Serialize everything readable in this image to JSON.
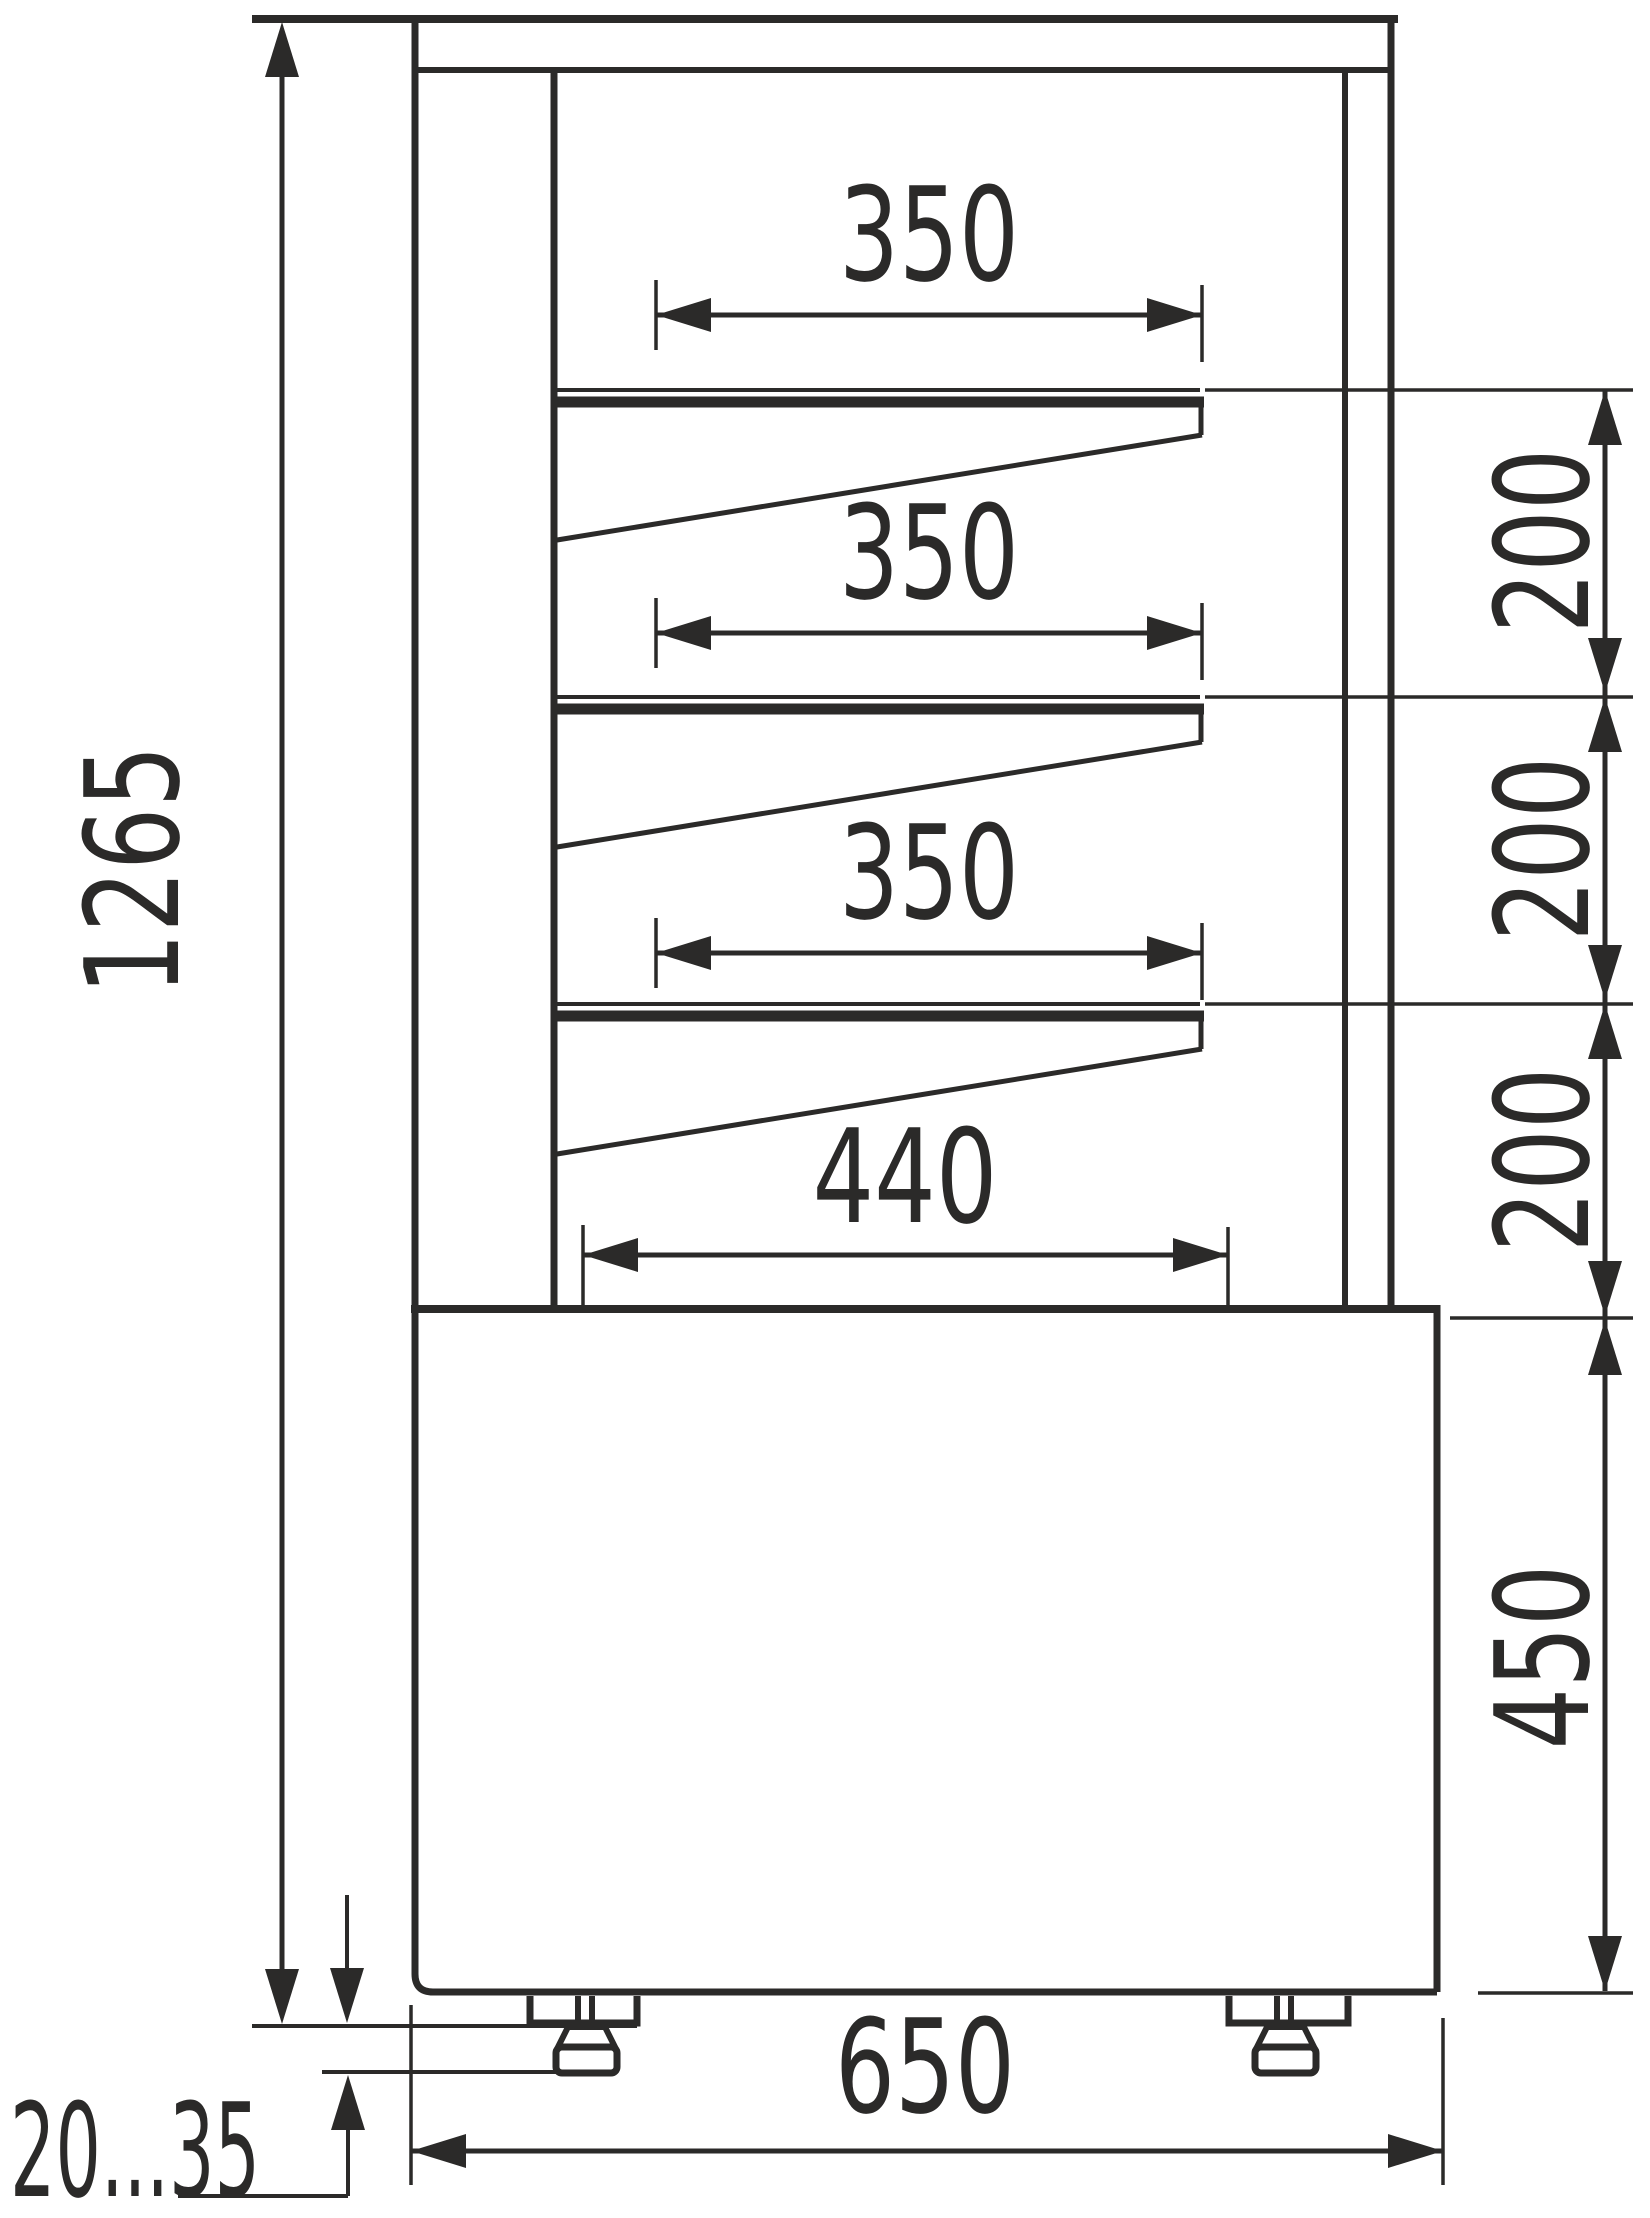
{
  "meta": {
    "drawing_type": "technical dimension drawing",
    "subject": "refrigerated confectionery display case - side section with shelves and adjustable feet",
    "line_color": "#2b2a29",
    "background_color": "#ffffff"
  },
  "dims": {
    "shelf_depth_1": "350",
    "shelf_depth_2": "350",
    "shelf_depth_3": "350",
    "bottom_depth": "440",
    "shelf_pitch_1": "200",
    "shelf_pitch_2": "200",
    "shelf_pitch_3": "200",
    "base_height": "450",
    "overall_height": "1265",
    "overall_depth": "650",
    "foot_adjust_range": "20...35"
  }
}
